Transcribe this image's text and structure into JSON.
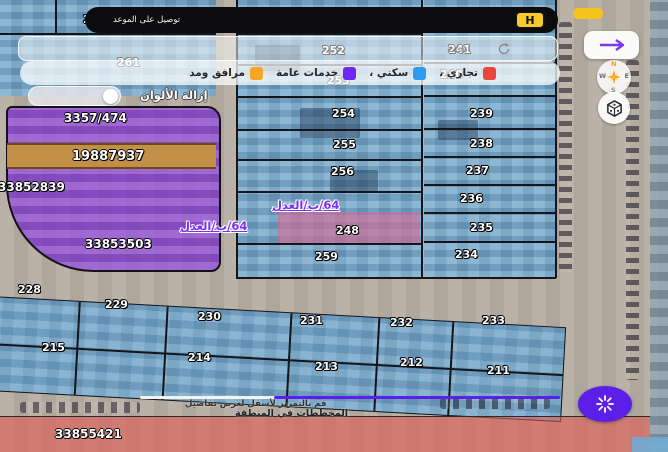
{
  "banner": {
    "text": "توصيل على الموعد",
    "logo_text": "H"
  },
  "search": {
    "placeholder": "ابحث"
  },
  "legend": {
    "items": [
      {
        "label": "تجاري ،",
        "color": "#e8453c"
      },
      {
        "label": "سكني ،",
        "color": "#2e9bf0"
      },
      {
        "label": "خدمات عامة",
        "color": "#6d28f0"
      },
      {
        "label": "مرافق ومد",
        "color": "#f5a623"
      }
    ]
  },
  "remove_colors": {
    "label": "إزالة الألوان",
    "state": "off"
  },
  "purple_block": {
    "deed_top": "3357/474",
    "strip_number": "19887937",
    "deed_left": "33852839",
    "deed_bottom": "33853503"
  },
  "plan_labels": {
    "upper": "64/ب/العدل",
    "lower": "64/ب/العدل"
  },
  "parcels": {
    "top_left": [
      "270",
      "261"
    ],
    "middle": [
      "252",
      "253",
      "254",
      "255",
      "256",
      "248",
      "259"
    ],
    "right": [
      "241",
      "240",
      "239",
      "238",
      "237",
      "236",
      "235",
      "234"
    ],
    "bottom_row1": [
      "228",
      "229",
      "230",
      "231",
      "232",
      "233"
    ],
    "bottom_row2": [
      "215",
      "214",
      "213",
      "212",
      "211"
    ]
  },
  "bottom_strip": {
    "hint_line1": "قم بالتمرير لأسفل لعرض تفاصيل",
    "hint_line2": "المخططات في المنطقة",
    "deed_number": "33855421"
  },
  "compass": {
    "n": "N",
    "e": "E",
    "w": "W",
    "s": "S"
  },
  "colors": {
    "residential_blue": "#71aad2",
    "services_purple": "#8a3fd8",
    "commercial_red": "#e05850",
    "utility_orange": "#c4943f",
    "accent_purple": "#5b1fe8",
    "banner_yellow": "#f7c92c"
  }
}
